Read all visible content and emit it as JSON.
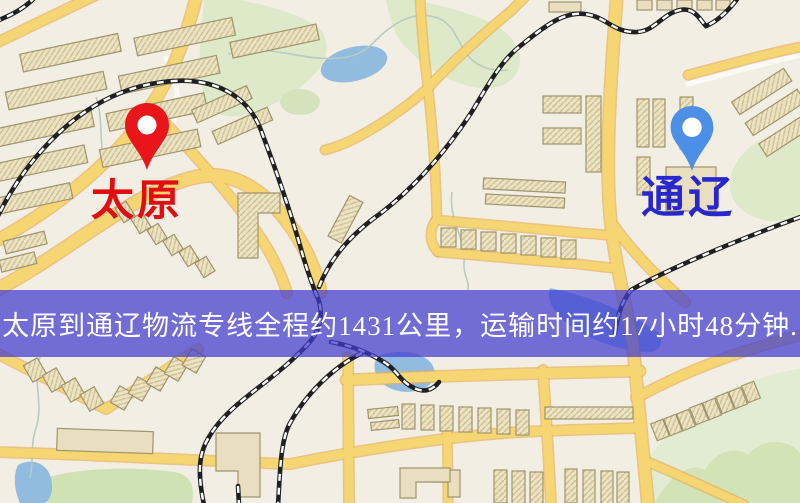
{
  "banner": {
    "text": "太原到通辽物流专线全程约1431公里，运输时间约17小时48分钟.",
    "background_color": "#3e3cd0",
    "text_color": "#ffffff"
  },
  "route": {
    "origin": "太原",
    "destination": "通辽",
    "distance_text": "约1431公里",
    "duration_text": "约17小时48分钟"
  },
  "markers": {
    "origin": {
      "label": "太原",
      "pin_color": "#e8151a",
      "hole_color": "#ffffff",
      "label_color": "#e20d10"
    },
    "destination": {
      "label": "通辽",
      "pin_color": "#4b8fe6",
      "hole_color": "#ffffff",
      "label_color": "#2727cd"
    }
  },
  "map_colors": {
    "base": "#f2eee3",
    "road_fill": "#f6d573",
    "road_edge": "#e8b058",
    "minor_road": "#fbfaf6",
    "building_fill": "#ece3c3",
    "building_stroke": "#a0946c",
    "green": "#dde9c8",
    "green_dark": "#cfe2b4",
    "water": "#92bcdf",
    "railway": "#202020",
    "stream": "#b6ccc2"
  }
}
